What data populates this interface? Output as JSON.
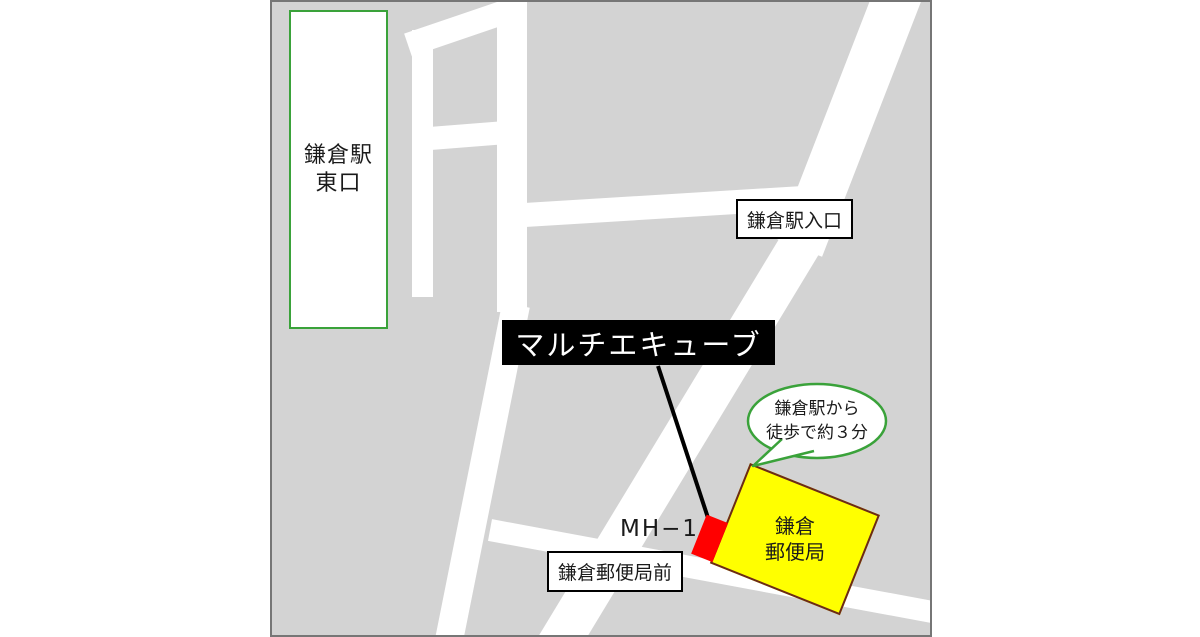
{
  "map": {
    "background": "#d3d3d3",
    "road_color": "#ffffff",
    "border_color": "#767676",
    "station": {
      "lines": [
        "鎌倉駅",
        "東口"
      ],
      "border_color": "#3aa23a"
    },
    "entrance_label": "鎌倉駅入口",
    "destination_label": "マルチエキューブ",
    "bus_stop_label": "鎌倉郵便局前",
    "marker": {
      "label": "MH−1",
      "color": "#ff0000"
    },
    "post_office": {
      "lines": [
        "鎌倉",
        "郵便局"
      ],
      "fill": "#ffff00",
      "border_color": "#6b2a18"
    },
    "bubble": {
      "lines": [
        "鎌倉駅から",
        "徒歩で約３分"
      ],
      "border_color": "#3aa23a"
    }
  }
}
